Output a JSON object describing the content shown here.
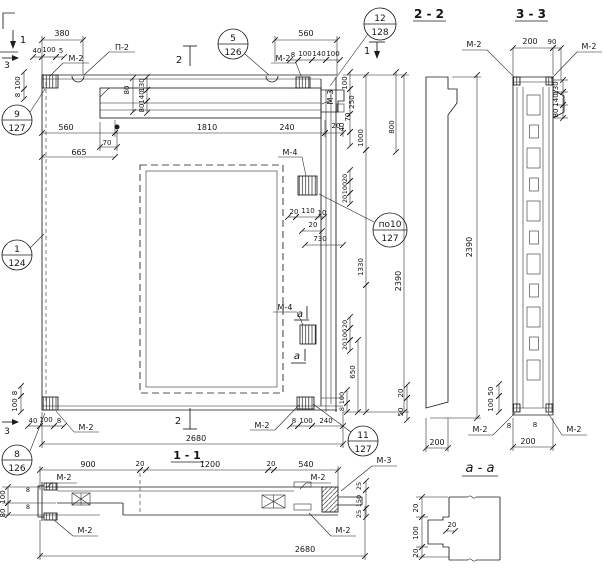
{
  "meta": {
    "background": "#ffffff",
    "ink": "#1c1c1c"
  },
  "label_groups": {
    "elevation": [
      {
        "t": "380",
        "x": 62,
        "y": 36,
        "n": "dim-380-top"
      },
      {
        "t": "40",
        "x": 37,
        "y": 53,
        "fs": 7
      },
      {
        "t": "100",
        "x": 49,
        "y": 52,
        "fs": 7
      },
      {
        "t": "5",
        "x": 61,
        "y": 53,
        "fs": 7
      },
      {
        "t": "М-2",
        "x": 76,
        "y": 61,
        "n": "embed-label-m2-topleft"
      },
      {
        "t": "П-2",
        "x": 122,
        "y": 50,
        "n": "loop-label-p2"
      },
      {
        "t": "560",
        "x": 306,
        "y": 36,
        "n": "dim-560-top"
      },
      {
        "t": "8",
        "x": 293,
        "y": 57,
        "fs": 7
      },
      {
        "t": "100",
        "x": 305,
        "y": 56,
        "fs": 7
      },
      {
        "t": "140",
        "x": 319,
        "y": 56,
        "fs": 7
      },
      {
        "t": "100",
        "x": 333,
        "y": 56,
        "fs": 7
      },
      {
        "t": "М-2",
        "x": 283,
        "y": 61,
        "n": "embed-label-m2-topmid"
      },
      {
        "t": "100",
        "x": 20,
        "y": 83,
        "r": -90,
        "fs": 7
      },
      {
        "t": "8",
        "x": 20,
        "y": 95,
        "r": -90,
        "fs": 7
      },
      {
        "t": "80",
        "x": 129,
        "y": 90,
        "r": -90,
        "fs": 7
      },
      {
        "t": "130",
        "x": 144,
        "y": 85,
        "r": -90,
        "fs": 7
      },
      {
        "t": "140",
        "x": 144,
        "y": 97,
        "r": -90,
        "fs": 7
      },
      {
        "t": "80",
        "x": 144,
        "y": 108,
        "r": -90,
        "fs": 7
      },
      {
        "t": "560",
        "x": 66,
        "y": 130,
        "n": "dim-560-inner"
      },
      {
        "t": "1810",
        "x": 207,
        "y": 130,
        "n": "dim-1810"
      },
      {
        "t": "240",
        "x": 287,
        "y": 130
      },
      {
        "t": "70",
        "x": 107,
        "y": 145,
        "fs": 7
      },
      {
        "t": "665",
        "x": 79,
        "y": 155,
        "n": "dim-665"
      },
      {
        "t": "М-3",
        "x": 333,
        "y": 97,
        "r": -90,
        "fs": 8,
        "n": "embed-label-m3-edge"
      },
      {
        "t": "100",
        "x": 347,
        "y": 83,
        "r": -90,
        "fs": 7
      },
      {
        "t": "250",
        "x": 354,
        "y": 102,
        "r": -90,
        "fs": 7
      },
      {
        "t": "70",
        "x": 350,
        "y": 117,
        "r": -90,
        "fs": 7
      },
      {
        "t": "40",
        "x": 344,
        "y": 127,
        "r": -90,
        "fs": 7
      },
      {
        "t": "20",
        "x": 336,
        "y": 128,
        "fs": 7
      },
      {
        "t": "1000",
        "x": 363,
        "y": 138,
        "r": -90,
        "fs": 7
      },
      {
        "t": "800",
        "x": 394,
        "y": 127,
        "r": -90,
        "fs": 7
      },
      {
        "t": "2390",
        "x": 401,
        "y": 281,
        "r": -90,
        "n": "dim-2390-elevation"
      },
      {
        "t": "1330",
        "x": 363,
        "y": 267,
        "r": -90,
        "fs": 7
      },
      {
        "t": "М-4",
        "x": 290,
        "y": 155,
        "n": "embed-label-m4-top"
      },
      {
        "t": "20",
        "x": 347,
        "y": 178,
        "r": -90,
        "fs": 6.5
      },
      {
        "t": "100",
        "x": 347,
        "y": 188,
        "r": -90,
        "fs": 6.5
      },
      {
        "t": "20",
        "x": 347,
        "y": 199,
        "r": -90,
        "fs": 6.5
      },
      {
        "t": "20",
        "x": 294,
        "y": 214,
        "fs": 7
      },
      {
        "t": "110",
        "x": 308,
        "y": 213,
        "fs": 7
      },
      {
        "t": "10",
        "x": 322,
        "y": 215,
        "fs": 7
      },
      {
        "t": "20",
        "x": 313,
        "y": 227,
        "fs": 7
      },
      {
        "t": "730",
        "x": 320,
        "y": 241,
        "fs": 7
      },
      {
        "t": "М-4",
        "x": 285,
        "y": 310,
        "n": "embed-label-m4-bottom"
      },
      {
        "t": "а",
        "x": 300,
        "y": 317,
        "it": 1,
        "fs": 10,
        "n": "cut-letter-a-upper"
      },
      {
        "t": "а",
        "x": 297,
        "y": 359,
        "it": 1,
        "fs": 10,
        "n": "cut-letter-a-lower"
      },
      {
        "t": "20",
        "x": 347,
        "y": 324,
        "r": -90,
        "fs": 6.5
      },
      {
        "t": "100",
        "x": 347,
        "y": 335,
        "r": -90,
        "fs": 6.5
      },
      {
        "t": "20",
        "x": 347,
        "y": 346,
        "r": -90,
        "fs": 6.5
      },
      {
        "t": "650",
        "x": 355,
        "y": 372,
        "r": -90,
        "fs": 7
      },
      {
        "t": "100",
        "x": 344,
        "y": 398,
        "r": -90,
        "fs": 6.5
      },
      {
        "t": "8",
        "x": 344,
        "y": 409,
        "r": -90,
        "fs": 6.5
      },
      {
        "t": "8",
        "x": 294,
        "y": 423,
        "fs": 7
      },
      {
        "t": "100",
        "x": 306,
        "y": 423,
        "fs": 7
      },
      {
        "t": "240",
        "x": 326,
        "y": 423,
        "fs": 7
      },
      {
        "t": "2680",
        "x": 196,
        "y": 441,
        "n": "dim-2680-elevation"
      },
      {
        "t": "40",
        "x": 33,
        "y": 423,
        "fs": 7
      },
      {
        "t": "100",
        "x": 46,
        "y": 422,
        "fs": 7
      },
      {
        "t": "8",
        "x": 59,
        "y": 423,
        "fs": 7
      },
      {
        "t": "8",
        "x": 17,
        "y": 393,
        "r": -90,
        "fs": 7
      },
      {
        "t": "100",
        "x": 17,
        "y": 405,
        "r": -90,
        "fs": 7
      },
      {
        "t": "М-2",
        "x": 86,
        "y": 430,
        "n": "embed-label-m2-botleft"
      },
      {
        "t": "М-2",
        "x": 262,
        "y": 428,
        "n": "embed-label-m2-botmid"
      }
    ],
    "cut_markers": [
      {
        "t": "1",
        "x": 23,
        "y": 43,
        "fs": 10,
        "n": "cut-mark-1-topleft"
      },
      {
        "t": "3",
        "x": 7,
        "y": 68,
        "fs": 9,
        "n": "cut-mark-3-top"
      },
      {
        "t": "2",
        "x": 179,
        "y": 63,
        "fs": 10,
        "n": "cut-mark-2-top"
      },
      {
        "t": "1",
        "x": 367,
        "y": 54,
        "fs": 10,
        "n": "cut-mark-1-right"
      },
      {
        "t": "2",
        "x": 178,
        "y": 424,
        "fs": 10,
        "n": "cut-mark-2-bottom"
      },
      {
        "t": "3",
        "x": 7,
        "y": 434,
        "fs": 9,
        "n": "cut-mark-3-bottom"
      }
    ],
    "section_2_2": [
      {
        "t": "2 - 2",
        "x": 429,
        "y": 18,
        "fs": 12,
        "b": 1,
        "n": "section-2-2-title"
      },
      {
        "t": "2390",
        "x": 472,
        "y": 247,
        "r": -90,
        "n": "dim-2390-section22"
      },
      {
        "t": "20",
        "x": 403,
        "y": 393,
        "r": -90,
        "fs": 7
      },
      {
        "t": "50",
        "x": 403,
        "y": 412,
        "r": -90,
        "fs": 7
      },
      {
        "t": "200",
        "x": 437,
        "y": 445,
        "n": "dim-200-section22"
      }
    ],
    "section_3_3": [
      {
        "t": "3 - 3",
        "x": 531,
        "y": 18,
        "fs": 12,
        "b": 1,
        "n": "section-3-3-title"
      },
      {
        "t": "М-2",
        "x": 474,
        "y": 47,
        "n": "embed-label-m2-33-topleft"
      },
      {
        "t": "М-2",
        "x": 589,
        "y": 49,
        "n": "embed-label-m2-33-topright"
      },
      {
        "t": "200",
        "x": 530,
        "y": 44
      },
      {
        "t": "90",
        "x": 552,
        "y": 44,
        "fs": 7
      },
      {
        "t": "130",
        "x": 558,
        "y": 88,
        "r": -90,
        "fs": 7
      },
      {
        "t": "140",
        "x": 558,
        "y": 100,
        "r": -90,
        "fs": 7
      },
      {
        "t": "80",
        "x": 558,
        "y": 113,
        "r": -90,
        "fs": 7
      },
      {
        "t": "50",
        "x": 493,
        "y": 391,
        "r": -90,
        "fs": 7
      },
      {
        "t": "100",
        "x": 493,
        "y": 405,
        "r": -90,
        "fs": 7
      },
      {
        "t": "М-2",
        "x": 480,
        "y": 432,
        "n": "embed-label-m2-33-botleft"
      },
      {
        "t": "М-2",
        "x": 574,
        "y": 432,
        "n": "embed-label-m2-33-botright"
      },
      {
        "t": "8",
        "x": 509,
        "y": 428,
        "fs": 7
      },
      {
        "t": "8",
        "x": 535,
        "y": 427,
        "fs": 7
      },
      {
        "t": "200",
        "x": 528,
        "y": 444,
        "n": "dim-200-section33"
      }
    ],
    "section_1_1": [
      {
        "t": "1 - 1",
        "x": 187,
        "y": 459,
        "fs": 11,
        "b": 1,
        "n": "section-1-1-title"
      },
      {
        "t": "900",
        "x": 88,
        "y": 467
      },
      {
        "t": "20",
        "x": 140,
        "y": 466,
        "fs": 7
      },
      {
        "t": "1200",
        "x": 210,
        "y": 467
      },
      {
        "t": "20",
        "x": 271,
        "y": 466,
        "fs": 7
      },
      {
        "t": "540",
        "x": 306,
        "y": 467
      },
      {
        "t": "М-2",
        "x": 64,
        "y": 480,
        "n": "embed-label-m2-11-topleft"
      },
      {
        "t": "М-2",
        "x": 318,
        "y": 480,
        "n": "embed-label-m2-11-topright"
      },
      {
        "t": "М-3",
        "x": 384,
        "y": 463,
        "n": "embed-label-m3-11"
      },
      {
        "t": "М-2",
        "x": 85,
        "y": 533,
        "n": "embed-label-m2-11-botleft"
      },
      {
        "t": "М-2",
        "x": 343,
        "y": 533,
        "n": "embed-label-m2-11-botright"
      },
      {
        "t": "100",
        "x": 5,
        "y": 497,
        "r": -90,
        "fs": 7
      },
      {
        "t": "80",
        "x": 5,
        "y": 513,
        "r": -90,
        "fs": 7
      },
      {
        "t": "8",
        "x": 28,
        "y": 492,
        "fs": 6.5
      },
      {
        "t": "8",
        "x": 28,
        "y": 509,
        "fs": 6.5
      },
      {
        "t": "25",
        "x": 361,
        "y": 486,
        "r": -90,
        "fs": 6.5
      },
      {
        "t": "150",
        "x": 361,
        "y": 501,
        "r": -90,
        "fs": 6.5
      },
      {
        "t": "25",
        "x": 361,
        "y": 514,
        "r": -90,
        "fs": 6.5
      },
      {
        "t": "2680",
        "x": 305,
        "y": 552,
        "n": "dim-2680-section11"
      }
    ],
    "section_a_a": [
      {
        "t": "а - а",
        "x": 480,
        "y": 472,
        "it": 1,
        "fs": 13,
        "n": "section-a-a-title"
      },
      {
        "t": "20",
        "x": 418,
        "y": 508,
        "r": -90,
        "fs": 7
      },
      {
        "t": "100",
        "x": 418,
        "y": 533,
        "r": -90,
        "fs": 7
      },
      {
        "t": "20",
        "x": 418,
        "y": 553,
        "r": -90,
        "fs": 7
      },
      {
        "t": "20",
        "x": 452,
        "y": 527,
        "fs": 7
      }
    ]
  },
  "callouts": [
    {
      "top": "9",
      "bottom": "127",
      "cx": 17,
      "cy": 120,
      "r": 15,
      "n": "callout-9-127"
    },
    {
      "top": "5",
      "bottom": "126",
      "cx": 233,
      "cy": 44,
      "r": 15,
      "n": "callout-5-126"
    },
    {
      "top": "12",
      "bottom": "128",
      "cx": 380,
      "cy": 24,
      "r": 16,
      "n": "callout-12-128"
    },
    {
      "top": "1",
      "bottom": "124",
      "cx": 17,
      "cy": 255,
      "r": 15,
      "n": "callout-1-124"
    },
    {
      "top": "8",
      "bottom": "126",
      "cx": 17,
      "cy": 460,
      "r": 15,
      "n": "callout-8-126"
    },
    {
      "top": "11",
      "bottom": "127",
      "cx": 363,
      "cy": 441,
      "r": 15,
      "n": "callout-11-127"
    },
    {
      "top": "по10",
      "bottom": "127",
      "cx": 390,
      "cy": 230,
      "r": 17,
      "n": "callout-po10-127"
    }
  ]
}
